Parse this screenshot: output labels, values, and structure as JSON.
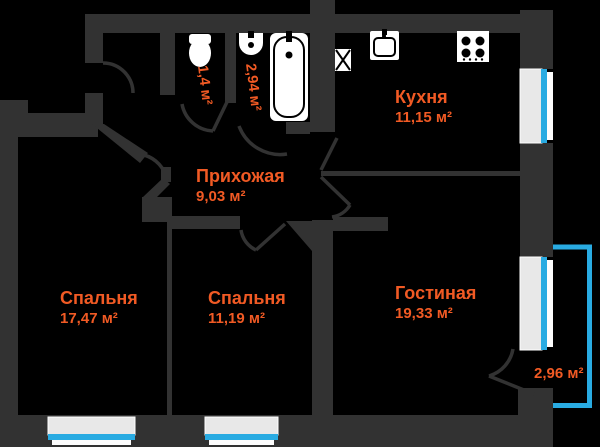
{
  "floorplan": {
    "title": "Apartment floor plan",
    "rooms": {
      "hallway": {
        "name": "Прихожая",
        "area": "9,03 м²"
      },
      "kitchen": {
        "name": "Кухня",
        "area": "11,15 м²"
      },
      "bedroom1": {
        "name": "Спальня",
        "area": "17,47 м²"
      },
      "bedroom2": {
        "name": "Спальня",
        "area": "11,19 м²"
      },
      "living": {
        "name": "Гостиная",
        "area": "19,33 м²"
      },
      "wc": {
        "area": "1,4 м²"
      },
      "bathroom": {
        "area": "2,94 м²"
      },
      "balcony": {
        "area": "2,96 м²"
      }
    },
    "colors": {
      "background": "#000000",
      "walls": "#323232",
      "labels": "#f15a24",
      "glazing_blue": "#29abe2",
      "window_frame": "#e8e8e8",
      "fixtures": "#ffffff"
    },
    "icons": [
      "toilet-icon",
      "sink-icon",
      "bathtub-icon",
      "kitchen-sink-icon",
      "stove-icon",
      "vent-shaft-icon"
    ]
  }
}
